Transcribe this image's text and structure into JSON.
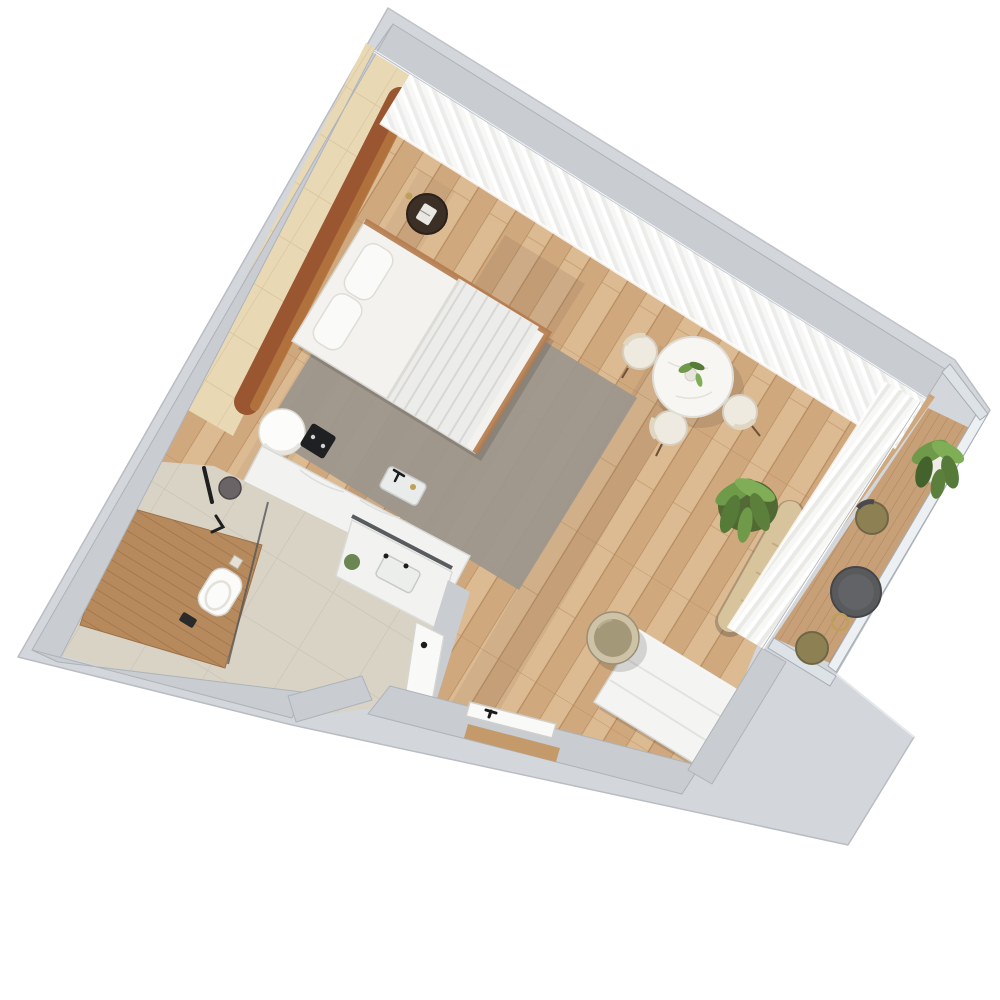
{
  "meta": {
    "title": "3D floor plan render — studio apartment, top-down axonometric view",
    "description": "Photorealistic top-view 3D floor plan of a studio apartment with bedroom-living area, bathroom, kitchenette counter, entry and balcony, shown rotated on a white background on a grey concrete slab."
  },
  "palette": {
    "background": "#ffffff",
    "slab": "#d3d6da",
    "slabEdge": "#b9bdc3",
    "wall": "#c9cdd2",
    "wallEdge": "#aeb3b9",
    "woodFloor": "#d5b288",
    "woodJoint": "#b58a5e",
    "rug": "#9d978d",
    "accentTileWall": "#e9d8b4",
    "accentTileJoint": "#d5c39c",
    "leather": "#9a5630",
    "leatherLight": "#b4753f",
    "bedWhite": "#f3f2ef",
    "bedFrameWood": "#b57b4c",
    "pillowWhite": "#fafaf8",
    "curtain": "#f4f4f1",
    "curtainShade": "#e9e9e5",
    "glassLine": "#b3bac0",
    "railing": "#edf0f2",
    "railingEdge": "#a6adb5",
    "balconyDeck": "#c8a078",
    "bathFloor": "#d9d3c6",
    "bathTileJoint": "#c8c2b4",
    "showerDeck": "#b68a5c",
    "marble": "#f2f3f1",
    "marbleVein": "#dcdedd",
    "toiletWhite": "#fbfbf9",
    "fixtureDark": "#1f2022",
    "door": "#f9f9f7",
    "dresser": "#f4f5f3",
    "poufRim": "#cec2a7",
    "poufTop": "#a39878",
    "bench": "#d8c49c",
    "planter": "#f0ede6",
    "plantGreen": "#6f9a4a",
    "plantGreenDark": "#44622c",
    "tableTop": "#f7f6f3",
    "chairCream": "#efeadf",
    "chairOlive": "#8d8154",
    "tableDark": "#595a5c",
    "brass": "#bfa05a",
    "shadow": "#7c6049"
  },
  "rooms": [
    {
      "id": "bedroom-living",
      "floor": "wood planks",
      "features": "double bed, leather headboard bench, rug, dining table, pouf"
    },
    {
      "id": "bathroom",
      "floor": "beige tile",
      "features": "walk-in shower with teak deck, wall-hung toilet, marble vanity"
    },
    {
      "id": "kitchenette",
      "floor": "wood planks",
      "features": "marble counter, cooktop, sink, round appliance"
    },
    {
      "id": "entry",
      "floor": "wood planks",
      "features": "entry door, bathroom door"
    },
    {
      "id": "balcony",
      "floor": "wood decking",
      "features": "glass railing, bistro table, two chairs, potted plant"
    }
  ],
  "furniture": [
    "double-bed",
    "leather-headboard",
    "side-table",
    "area-rug",
    "dining-table",
    "dining-chairs",
    "floor-pouf",
    "white-dresser",
    "window-bench",
    "potted-palm",
    "balcony-plant",
    "balcony-table",
    "balcony-chairs",
    "toilet",
    "vanity",
    "shower-set",
    "kitchen-counter",
    "cooktop",
    "kitchen-sink",
    "entry-door",
    "bathroom-door"
  ]
}
